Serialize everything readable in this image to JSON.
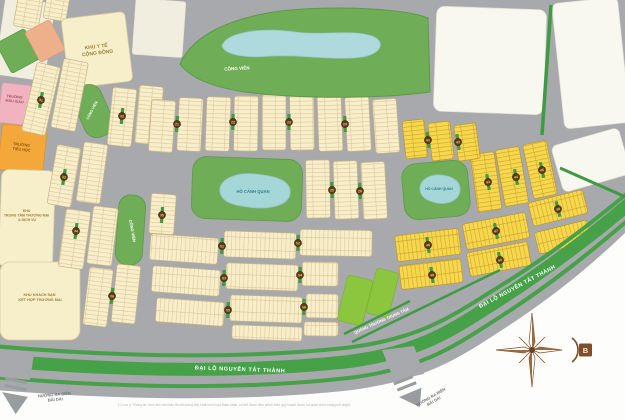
{
  "map_title": "Residential master plan map",
  "labels": {
    "medical": {
      "l1": "KHU Y TẾ",
      "l2": "CỘNG ĐỒNG"
    },
    "kindergarten": {
      "l1": "TRƯỜNG",
      "l2": "MẪU GIÁO"
    },
    "primary_school": {
      "l1": "TRƯỜNG",
      "l2": "TIỂU HỌC"
    },
    "commercial_center": {
      "l1": "KHU",
      "l2": "TRUNG TÂM THƯƠNG MẠI",
      "l3": "& DỊCH VỤ"
    },
    "hotel": {
      "l1": "KHU KHÁCH SẠN",
      "l2": "KẾT HỢP THƯƠNG MẠI"
    },
    "park": "CÔNG VIÊN",
    "lake": "HỒ CẢNH QUAN",
    "boulevard": "ĐẠI LỘ NGUYỄN TẤT THÀNH",
    "central_square": "QUẢNG TRƯỜNG TRUNG TÂM",
    "to_beach": {
      "l1": "HƯỚNG RA BIỂN",
      "l2": "BÃI DÀI"
    },
    "compass_north": "B",
    "disclaimer": "(*) Lưu ý: Thông tin, hình ảnh trên bản đồ chỉ mang tính chất minh họa tham khảo, có thể được điều chỉnh theo quy hoạch được cơ quan chức năng phê duyệt."
  },
  "colors": {
    "road_gray": "#a7a9ac",
    "land_ivory": "#f1eee0",
    "lot_cream": "#f8eec9",
    "lot_yellow": "#f7d74b",
    "park_green": "#6fae57",
    "bright_green": "#8cc63f",
    "median_green": "#46a149",
    "lake_blue": "#a5d6d8",
    "marker_brown": "#5a3820",
    "compass_brown": "#7d4e2a",
    "white_area": "#fdfdfb"
  },
  "blocks": [
    {
      "x": 0,
      "y": 0,
      "w": 50,
      "h": 78,
      "r": 8,
      "t": "ivory"
    },
    {
      "x": 134,
      "y": 0,
      "w": 50,
      "h": 56,
      "r": 4,
      "t": "ivory"
    },
    {
      "x": 16,
      "y": -6,
      "w": 25,
      "h": 34,
      "r": 10,
      "t": "ct"
    },
    {
      "x": 45,
      "y": -6,
      "w": 23,
      "h": 26,
      "r": 10,
      "t": "ct"
    },
    {
      "x": 2,
      "y": 34,
      "w": 32,
      "h": 34,
      "r": -28,
      "t": "green"
    },
    {
      "x": 31,
      "y": 24,
      "w": 28,
      "h": 34,
      "r": -28,
      "t": "salmon"
    },
    {
      "x": 65,
      "y": 15,
      "w": 64,
      "h": 70,
      "r": -7,
      "t": "plain",
      "rx": 5
    },
    {
      "x": 435,
      "y": 8,
      "w": 110,
      "h": 105,
      "r": 2,
      "t": "white",
      "rx": 8
    },
    {
      "x": 558,
      "y": 0,
      "w": 66,
      "h": 126,
      "r": -6,
      "t": "white",
      "rx": 6
    },
    {
      "x": 556,
      "y": 136,
      "w": 70,
      "h": 48,
      "r": -16,
      "t": "white",
      "rx": 6
    },
    {
      "x": 0,
      "y": 84,
      "w": 30,
      "h": 40,
      "r": 6,
      "t": "pink"
    },
    {
      "x": 0,
      "y": 126,
      "w": 45,
      "h": 46,
      "r": 6,
      "t": "orange"
    },
    {
      "x": 0,
      "y": 170,
      "w": 54,
      "h": 98,
      "r": 2,
      "t": "plain",
      "rx": 8
    },
    {
      "x": 0,
      "y": 262,
      "w": 80,
      "h": 78,
      "r": 0,
      "t": "plain",
      "rx": 10
    },
    {
      "x": 192,
      "y": 158,
      "w": 110,
      "h": 62,
      "r": 2,
      "t": "green",
      "rx": 14
    },
    {
      "x": 403,
      "y": 162,
      "w": 66,
      "h": 56,
      "r": -5,
      "t": "green",
      "rx": 14
    },
    {
      "x": 117,
      "y": 195,
      "w": 27,
      "h": 70,
      "r": 4,
      "t": "green",
      "rx": 12
    },
    {
      "x": 78,
      "y": 84,
      "w": 30,
      "h": 54,
      "r": -24,
      "t": "green",
      "rx": 13
    },
    {
      "x": 342,
      "y": 277,
      "w": 26,
      "h": 47,
      "r": 14,
      "t": "bgreen",
      "rx": 3
    },
    {
      "x": 371,
      "y": 270,
      "w": 23,
      "h": 46,
      "r": 14,
      "t": "bgreen",
      "rx": 3
    },
    {
      "x": 29,
      "y": 64,
      "w": 24,
      "h": 70,
      "r": 13,
      "t": "ct"
    },
    {
      "x": 57,
      "y": 60,
      "w": 25,
      "h": 70,
      "r": 11,
      "t": "ct"
    },
    {
      "x": 110,
      "y": 88,
      "w": 24,
      "h": 58,
      "r": 6,
      "t": "ct"
    },
    {
      "x": 137,
      "y": 86,
      "w": 24,
      "h": 58,
      "r": 5,
      "t": "ct"
    },
    {
      "x": 52,
      "y": 146,
      "w": 24,
      "h": 60,
      "r": 10,
      "t": "ct"
    },
    {
      "x": 80,
      "y": 143,
      "w": 24,
      "h": 60,
      "r": 8,
      "t": "ct"
    },
    {
      "x": 62,
      "y": 210,
      "w": 25,
      "h": 58,
      "r": 8,
      "t": "ct"
    },
    {
      "x": 90,
      "y": 207,
      "w": 25,
      "h": 58,
      "r": 7,
      "t": "ct"
    },
    {
      "x": 150,
      "y": 194,
      "w": 25,
      "h": 40,
      "r": 4,
      "t": "ct"
    },
    {
      "x": 86,
      "y": 268,
      "w": 24,
      "h": 58,
      "r": 7,
      "t": "ct"
    },
    {
      "x": 114,
      "y": 265,
      "w": 24,
      "h": 58,
      "r": 6,
      "t": "ct"
    },
    {
      "x": 150,
      "y": 100,
      "w": 24,
      "h": 52,
      "r": 4,
      "t": "ct"
    },
    {
      "x": 178,
      "y": 98,
      "w": 24,
      "h": 53,
      "r": 3,
      "t": "ct"
    },
    {
      "x": 206,
      "y": 97,
      "w": 24,
      "h": 54,
      "r": 2,
      "t": "ct"
    },
    {
      "x": 234,
      "y": 96,
      "w": 24,
      "h": 55,
      "r": 1,
      "t": "ct"
    },
    {
      "x": 262,
      "y": 95,
      "w": 24,
      "h": 55,
      "r": 0,
      "t": "ct"
    },
    {
      "x": 290,
      "y": 95,
      "w": 24,
      "h": 55,
      "r": -1,
      "t": "ct"
    },
    {
      "x": 318,
      "y": 96,
      "w": 24,
      "h": 55,
      "r": -2,
      "t": "ct"
    },
    {
      "x": 346,
      "y": 97,
      "w": 24,
      "h": 54,
      "r": -3,
      "t": "ct"
    },
    {
      "x": 374,
      "y": 99,
      "w": 24,
      "h": 54,
      "r": -4,
      "t": "ct"
    },
    {
      "x": 306,
      "y": 160,
      "w": 24,
      "h": 58,
      "r": -1,
      "t": "ct"
    },
    {
      "x": 334,
      "y": 161,
      "w": 24,
      "h": 58,
      "r": -2,
      "t": "ct"
    },
    {
      "x": 362,
      "y": 162,
      "w": 24,
      "h": 57,
      "r": -3,
      "t": "ct"
    },
    {
      "x": 474,
      "y": 153,
      "w": 24,
      "h": 58,
      "r": -8,
      "t": "yt"
    },
    {
      "x": 500,
      "y": 148,
      "w": 24,
      "h": 57,
      "r": -10,
      "t": "yt"
    },
    {
      "x": 528,
      "y": 142,
      "w": 24,
      "h": 55,
      "r": -12,
      "t": "yt"
    },
    {
      "x": 404,
      "y": 120,
      "w": 22,
      "h": 38,
      "r": -6,
      "t": "yt"
    },
    {
      "x": 430,
      "y": 122,
      "w": 22,
      "h": 38,
      "r": -7,
      "t": "yt"
    },
    {
      "x": 456,
      "y": 124,
      "w": 22,
      "h": 36,
      "r": -8,
      "t": "yt"
    },
    {
      "x": 396,
      "y": 232,
      "w": 64,
      "h": 26,
      "r": -7,
      "t": "yw"
    },
    {
      "x": 464,
      "y": 218,
      "w": 64,
      "h": 26,
      "r": -11,
      "t": "yw"
    },
    {
      "x": 530,
      "y": 196,
      "w": 56,
      "h": 24,
      "r": -14,
      "t": "yw"
    },
    {
      "x": 400,
      "y": 262,
      "w": 62,
      "h": 24,
      "r": -7,
      "t": "yw"
    },
    {
      "x": 468,
      "y": 247,
      "w": 62,
      "h": 24,
      "r": -11,
      "t": "yw"
    },
    {
      "x": 536,
      "y": 226,
      "w": 54,
      "h": 22,
      "r": -14,
      "t": "yw"
    },
    {
      "x": 150,
      "y": 236,
      "w": 68,
      "h": 26,
      "r": 4,
      "t": "cw"
    },
    {
      "x": 224,
      "y": 232,
      "w": 72,
      "h": 26,
      "r": 2,
      "t": "cw"
    },
    {
      "x": 300,
      "y": 230,
      "w": 72,
      "h": 26,
      "r": 1,
      "t": "cw"
    },
    {
      "x": 152,
      "y": 268,
      "w": 68,
      "h": 26,
      "r": 4,
      "t": "cw"
    },
    {
      "x": 226,
      "y": 264,
      "w": 72,
      "h": 26,
      "r": 2,
      "t": "cw"
    },
    {
      "x": 302,
      "y": 262,
      "w": 36,
      "h": 24,
      "r": 1,
      "t": "cw"
    },
    {
      "x": 156,
      "y": 300,
      "w": 68,
      "h": 24,
      "r": 4,
      "t": "cw"
    },
    {
      "x": 230,
      "y": 296,
      "w": 72,
      "h": 26,
      "r": 2,
      "t": "cw"
    },
    {
      "x": 306,
      "y": 294,
      "w": 32,
      "h": 24,
      "r": 1,
      "t": "cw"
    },
    {
      "x": 232,
      "y": 326,
      "w": 70,
      "h": 14,
      "r": 2,
      "t": "cw"
    },
    {
      "x": 304,
      "y": 322,
      "w": 34,
      "h": 14,
      "r": 1,
      "t": "cw"
    }
  ],
  "markers": [
    {
      "x": 41,
      "y": 100,
      "n": "31",
      "r": 10
    },
    {
      "x": 122,
      "y": 116,
      "n": "32",
      "r": 5
    },
    {
      "x": 64,
      "y": 177,
      "n": "33",
      "r": 9
    },
    {
      "x": 76,
      "y": 231,
      "n": "34",
      "r": 7
    },
    {
      "x": 162,
      "y": 215,
      "n": "35",
      "r": 4
    },
    {
      "x": 112,
      "y": 296,
      "n": "36",
      "r": 6
    },
    {
      "x": 177,
      "y": 124,
      "n": "21",
      "r": 3
    },
    {
      "x": 233,
      "y": 122,
      "n": "22",
      "r": 1
    },
    {
      "x": 289,
      "y": 122,
      "n": "23",
      "r": 0
    },
    {
      "x": 345,
      "y": 124,
      "n": "24",
      "r": -2
    },
    {
      "x": 332,
      "y": 190,
      "n": "25",
      "r": -2
    },
    {
      "x": 360,
      "y": 191,
      "n": "26",
      "r": -3
    },
    {
      "x": 222,
      "y": 246,
      "n": "51",
      "r": 2
    },
    {
      "x": 298,
      "y": 243,
      "n": "52",
      "r": 1
    },
    {
      "x": 224,
      "y": 278,
      "n": "53",
      "r": 2
    },
    {
      "x": 300,
      "y": 275,
      "n": "54",
      "r": 1
    },
    {
      "x": 228,
      "y": 310,
      "n": "55",
      "r": 2
    },
    {
      "x": 304,
      "y": 307,
      "n": "56",
      "r": 1
    },
    {
      "x": 428,
      "y": 140,
      "n": "41",
      "r": -7
    },
    {
      "x": 458,
      "y": 142,
      "n": "42",
      "r": -8
    },
    {
      "x": 488,
      "y": 182,
      "n": "43",
      "r": -9
    },
    {
      "x": 516,
      "y": 177,
      "n": "44",
      "r": -11
    },
    {
      "x": 542,
      "y": 170,
      "n": "45",
      "r": -12
    },
    {
      "x": 428,
      "y": 245,
      "n": "46",
      "r": -8
    },
    {
      "x": 496,
      "y": 231,
      "n": "47",
      "r": -11
    },
    {
      "x": 558,
      "y": 209,
      "n": "48",
      "r": -14
    },
    {
      "x": 432,
      "y": 275,
      "n": "49",
      "r": -8
    },
    {
      "x": 500,
      "y": 260,
      "n": "50",
      "r": -11
    }
  ]
}
